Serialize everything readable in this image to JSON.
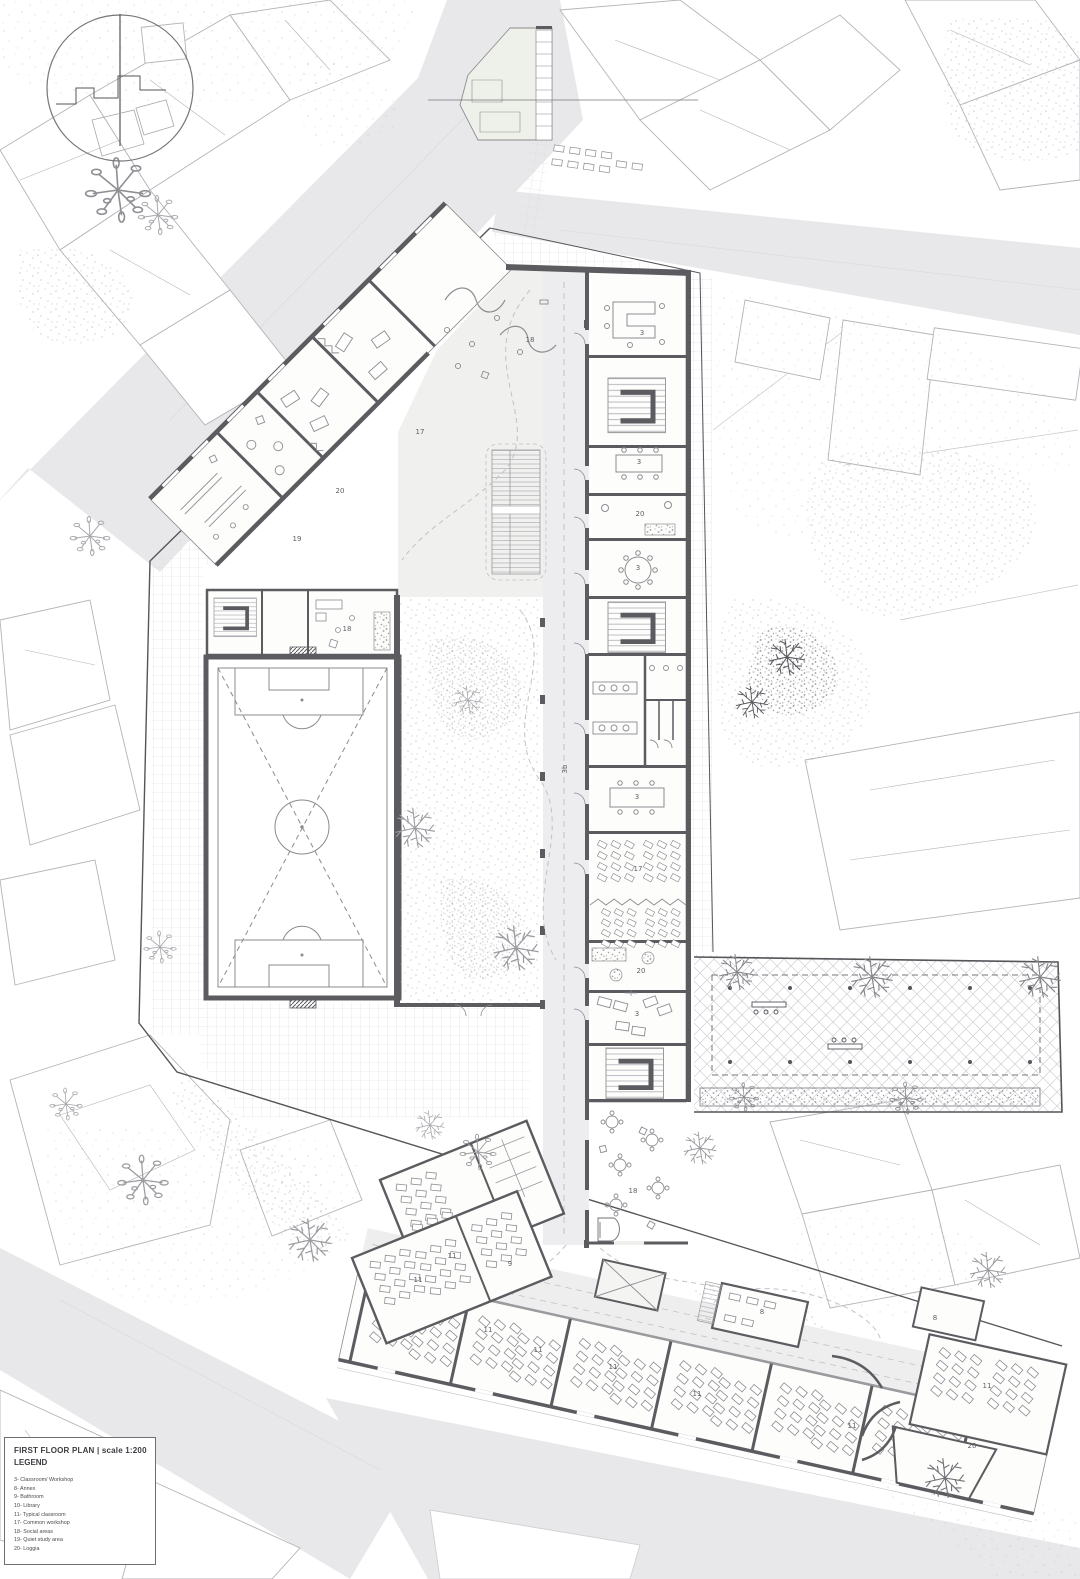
{
  "colors": {
    "paper": "#ffffff",
    "street": "#e8e8ea",
    "wall": "#5b5b60",
    "floor": "#efefed",
    "floor_warm": "#f0efeb",
    "line_light": "#b6b6bb",
    "line_mid": "#8d8d92",
    "boundary": "#55555a",
    "label": "#5f5f66"
  },
  "legend": {
    "title": "FIRST FLOOR PLAN",
    "separator": " | ",
    "scale": "scale 1:200",
    "heading": "LEGEND",
    "items": [
      {
        "num": "3-",
        "label": "Classroom/ Workshop"
      },
      {
        "num": "8-",
        "label": "Annex"
      },
      {
        "num": "9-",
        "label": "Bathroom"
      },
      {
        "num": "10-",
        "label": "Library"
      },
      {
        "num": "11-",
        "label": "Typical classroom"
      },
      {
        "num": "17-",
        "label": "Common workshop"
      },
      {
        "num": "18-",
        "label": "Social areas"
      },
      {
        "num": "19-",
        "label": "Quiet study area"
      },
      {
        "num": "20-",
        "label": "Loggia"
      }
    ]
  },
  "plan_labels": [
    {
      "x": 530,
      "y": 342,
      "text": "18"
    },
    {
      "x": 420,
      "y": 434,
      "text": "17"
    },
    {
      "x": 340,
      "y": 493,
      "text": "20"
    },
    {
      "x": 297,
      "y": 541,
      "text": "19"
    },
    {
      "x": 347,
      "y": 631,
      "text": "18"
    },
    {
      "x": 642,
      "y": 335,
      "text": "3"
    },
    {
      "x": 639,
      "y": 464,
      "text": "3"
    },
    {
      "x": 640,
      "y": 516,
      "text": "20"
    },
    {
      "x": 638,
      "y": 570,
      "text": "3"
    },
    {
      "x": 637,
      "y": 799,
      "text": "3"
    },
    {
      "x": 638,
      "y": 871,
      "text": "17"
    },
    {
      "x": 641,
      "y": 973,
      "text": "20"
    },
    {
      "x": 637,
      "y": 1016,
      "text": "3"
    },
    {
      "x": 567,
      "y": 769,
      "text": "3b",
      "rot": -90
    },
    {
      "x": 633,
      "y": 1193,
      "text": "18"
    },
    {
      "x": 452,
      "y": 1258,
      "text": "11"
    },
    {
      "x": 510,
      "y": 1266,
      "text": "9"
    },
    {
      "x": 418,
      "y": 1282,
      "text": "11"
    },
    {
      "x": 488,
      "y": 1332,
      "text": "11"
    },
    {
      "x": 538,
      "y": 1352,
      "text": "11"
    },
    {
      "x": 613,
      "y": 1369,
      "text": "11"
    },
    {
      "x": 697,
      "y": 1396,
      "text": "11"
    },
    {
      "x": 762,
      "y": 1314,
      "text": "8"
    },
    {
      "x": 935,
      "y": 1320,
      "text": "8"
    },
    {
      "x": 852,
      "y": 1428,
      "text": "11"
    },
    {
      "x": 987,
      "y": 1388,
      "text": "11"
    },
    {
      "x": 972,
      "y": 1448,
      "text": "20"
    }
  ]
}
